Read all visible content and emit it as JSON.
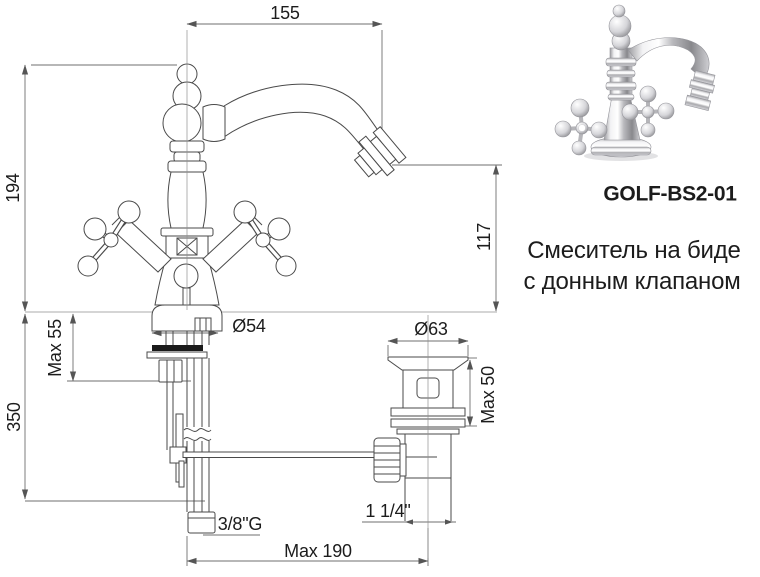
{
  "title_block": {
    "product_code": "GOLF-BS2-01",
    "description_line1": "Смеситель на биде",
    "description_line2": "с донным клапаном"
  },
  "dimensions": {
    "spout_reach_mm": "155",
    "body_height_mm": "194",
    "spout_outlet_height_mm": "117",
    "base_diameter": "Ø54",
    "max_deck_thickness": "Max 55",
    "supply_pipe_length_mm": "350",
    "drain_flange_diameter": "Ø63",
    "drain_max_deck_thickness": "Max 50",
    "supply_thread": "3/8\"G",
    "drain_thread": "1 1/4\"",
    "max_center_distance": "Max 190"
  },
  "colors": {
    "background": "#ffffff",
    "drawing_line": "#4a4a4a",
    "dimension_line": "#6f6f6f",
    "text": "#1c1c1c",
    "gasket_fill": "#1a1a1a"
  }
}
